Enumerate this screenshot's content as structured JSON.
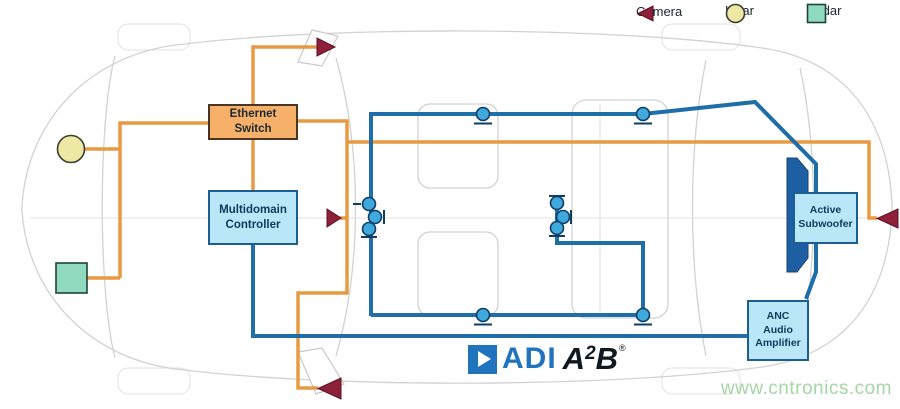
{
  "legend": {
    "items": [
      {
        "label": "Camera",
        "icon": "camera-icon",
        "shape": "left-triangle"
      },
      {
        "label": "Lidar",
        "icon": "lidar-icon",
        "shape": "circle"
      },
      {
        "label": "Radar",
        "icon": "radar-icon",
        "shape": "square"
      }
    ]
  },
  "components": {
    "ethernet_switch": {
      "lines": [
        "Ethernet",
        "Switch"
      ]
    },
    "multidomain_controller": {
      "lines": [
        "Multidomain",
        "Controller"
      ]
    },
    "active_subwoofer": {
      "lines": [
        "Active",
        "Subwoofer"
      ]
    },
    "anc_amplifier": {
      "lines": [
        "ANC",
        "Audio",
        "Amplifier"
      ]
    }
  },
  "logo": {
    "adi": "ADI",
    "a2b_a": "A",
    "a2b_sup": "2",
    "a2b_b": "B",
    "registered": "®"
  },
  "watermark": "www.cntronics.com",
  "colors": {
    "wire_orange": "#E89A43",
    "wire_blue": "#1E6EA9",
    "node_fill": "#3FA8DC",
    "box_blue_fill": "#B9E7F7",
    "box_blue_border": "#1C5E8F",
    "box_orange_fill": "#F6B06A",
    "box_orange_border": "#4A3423",
    "camera": "#8E2039",
    "lidar": "#EDE9A4",
    "radar": "#8FD9BE",
    "adi_blue": "#2074BE",
    "a2b_dark": "#101820",
    "watermark_green": "#A5D6A5",
    "sketch_gray": "#D2D2D2"
  }
}
